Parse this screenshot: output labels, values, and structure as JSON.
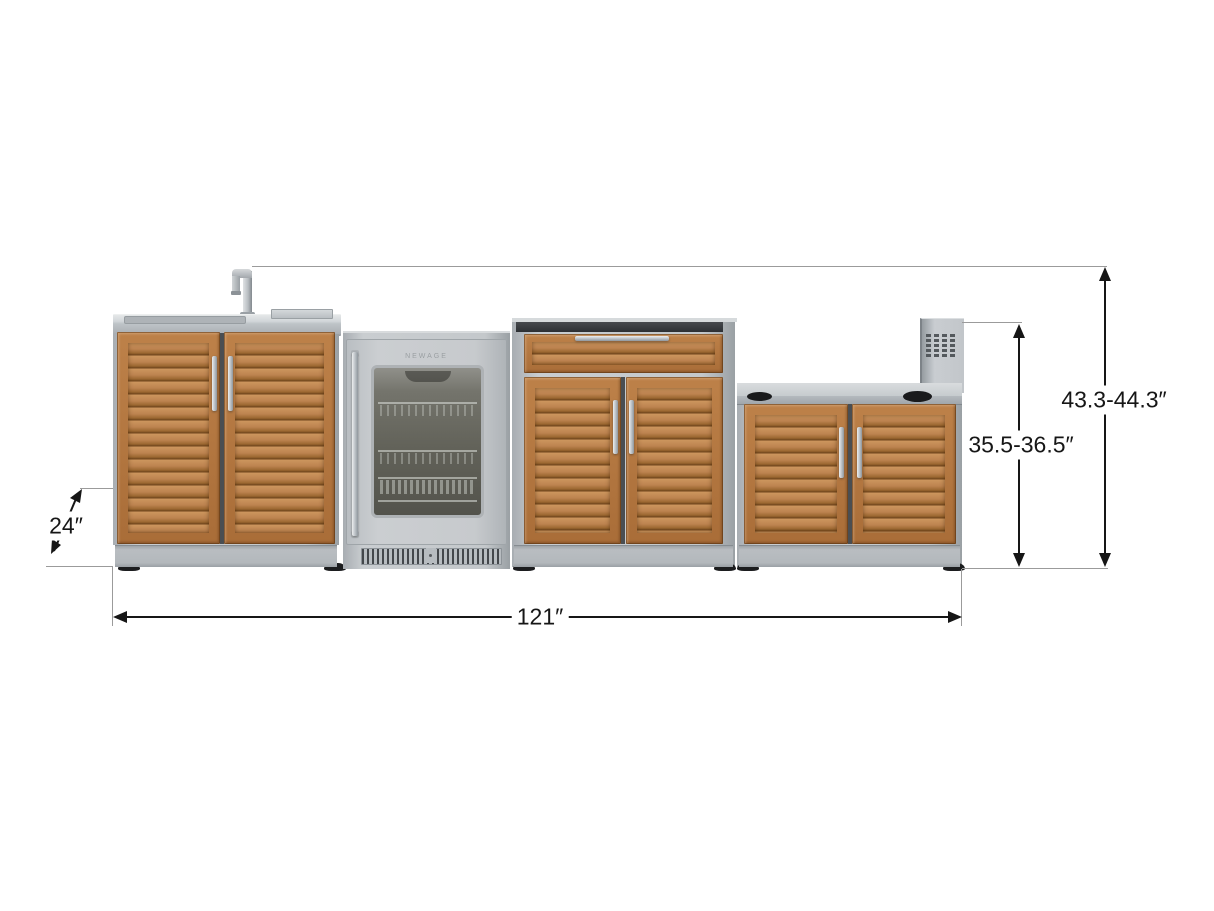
{
  "annotations": {
    "faucet_height": "43.3-44.3″",
    "counter_height": "35.5-36.5″",
    "depth": "24″",
    "overall_width": "121″"
  },
  "fridge": {
    "brand": "NEWAGE"
  },
  "colors": {
    "wood": "#b67c46",
    "wood_light": "#cc955d",
    "wood_dark": "#6f451c",
    "stainless": "#c6cacd",
    "stainless_dark": "#9aa0a5",
    "counter_dark": "#35383c",
    "annotation": "#161616",
    "extension_line": "#9b9b9b"
  }
}
